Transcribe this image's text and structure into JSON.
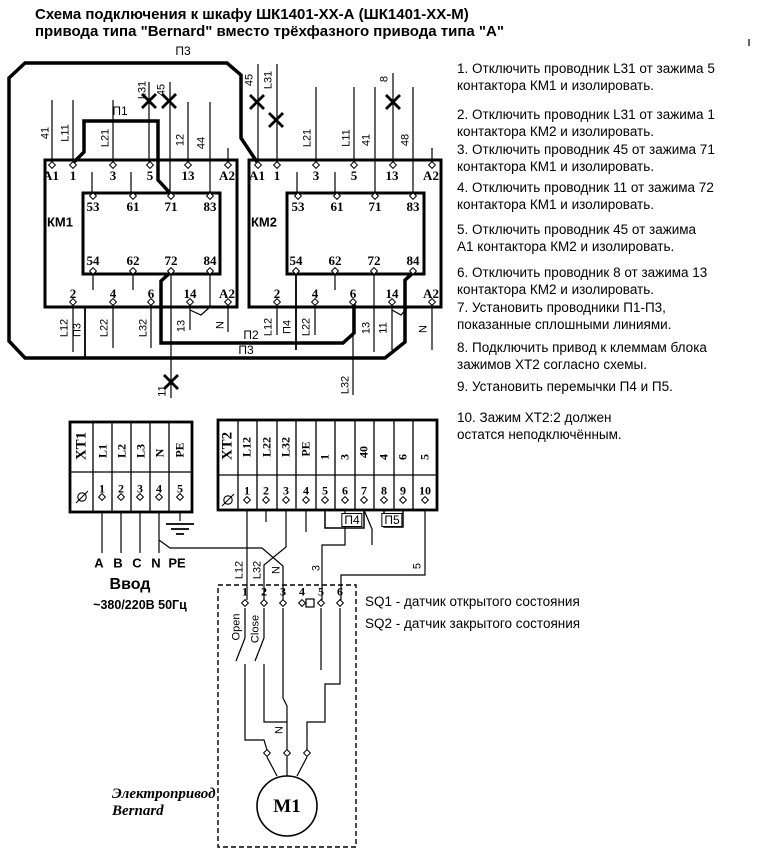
{
  "title": {
    "line1": "Схема подключения к шкафу ШК1401-ХХ-А (ШК1401-ХХ-М)",
    "line2": "привода типа \"Bernard\" вместо трёхфазного привода типа \"А\""
  },
  "instructions": [
    "1. Отключить проводник L31 от зажима 5\nконтактора КМ1 и изолировать.",
    "2. Отключить проводник L31 от зажима 1\nконтактора КМ2 и изолировать.",
    "3. Отключить проводник 45 от зажима 71\nконтактора КМ1 и изолировать.",
    "4. Отключить проводник 11 от зажима 72\nконтактора КМ1 и изолировать.",
    "5. Отключить проводник 45 от зажима\nА1 контактора КМ2 и изолировать.",
    "6. Отключить проводник 8 от зажима 13\nконтактора КМ2 и изолировать.",
    "7. Установить проводники П1-П3,\nпоказанные сплошными линиями.",
    "8. Подключить привод к клеммам блока\nзажимов ХТ2 согласно схемы.",
    "9. Установить перемычки П4 и П5.",
    "10. Зажим ХТ2:2 должен\nостатся неподключённым."
  ],
  "km1": {
    "name": "КМ1",
    "top": [
      "A1",
      "1",
      "3",
      "5",
      "13",
      "A2"
    ],
    "inner_top": [
      "53",
      "61",
      "71",
      "83"
    ],
    "inner_bottom": [
      "54",
      "62",
      "72",
      "84"
    ],
    "bottom": [
      "2",
      "4",
      "6",
      "14",
      "A2"
    ],
    "top_wires": [
      "41",
      "L11",
      "L21",
      "L31",
      "45",
      "12",
      "44"
    ],
    "bottom_wires": [
      "L12",
      "П3",
      "L22",
      "L32",
      "13",
      "N"
    ],
    "cut_wire": "11"
  },
  "km2": {
    "name": "КМ2",
    "top": [
      "A1",
      "1",
      "3",
      "5",
      "13",
      "A2"
    ],
    "inner_top": [
      "53",
      "61",
      "71",
      "83"
    ],
    "inner_bottom": [
      "54",
      "62",
      "72",
      "84"
    ],
    "bottom": [
      "2",
      "4",
      "6",
      "14",
      "A2"
    ],
    "top_wires": [
      "45",
      "L31",
      "L21",
      "L11",
      "41",
      "8",
      "48"
    ],
    "bottom_wires": [
      "L12",
      "П4",
      "L22",
      "L32",
      "13",
      "11",
      "N"
    ]
  },
  "jumpers": {
    "p1": "П1",
    "p2": "П2",
    "p3": "П3",
    "p4": "П4",
    "p5": "П5"
  },
  "xt1": {
    "name": "XT1",
    "columns": [
      "L1",
      "L2",
      "L3",
      "N",
      "PE"
    ],
    "numbers": [
      "1",
      "2",
      "3",
      "4",
      "5"
    ]
  },
  "xt2": {
    "name": "XT2",
    "columns": [
      "L12",
      "L22",
      "L32",
      "PE",
      "1",
      "3",
      "40",
      "4",
      "6",
      "5"
    ],
    "numbers": [
      "1",
      "2",
      "3",
      "4",
      "5",
      "6",
      "7",
      "8",
      "9",
      "10"
    ]
  },
  "input": {
    "phases": [
      "A",
      "B",
      "C",
      "N",
      "PE"
    ],
    "label": "Ввод",
    "voltage": "~380/220В 50Гц"
  },
  "bernard": {
    "terminals": [
      "1",
      "2",
      "3",
      "4",
      "5",
      "6"
    ],
    "open_label": "Open",
    "close_label": "Close",
    "wire_labels": [
      "L12",
      "L32",
      "N",
      "3",
      "5"
    ],
    "neutral": "N",
    "motor": "M1",
    "caption_line1": "Электропривод",
    "caption_line2": "Bernard"
  },
  "legend": {
    "sq1": "SQ1 - датчик открытого состояния",
    "sq2": "SQ2 - датчик закрытого состояния"
  }
}
